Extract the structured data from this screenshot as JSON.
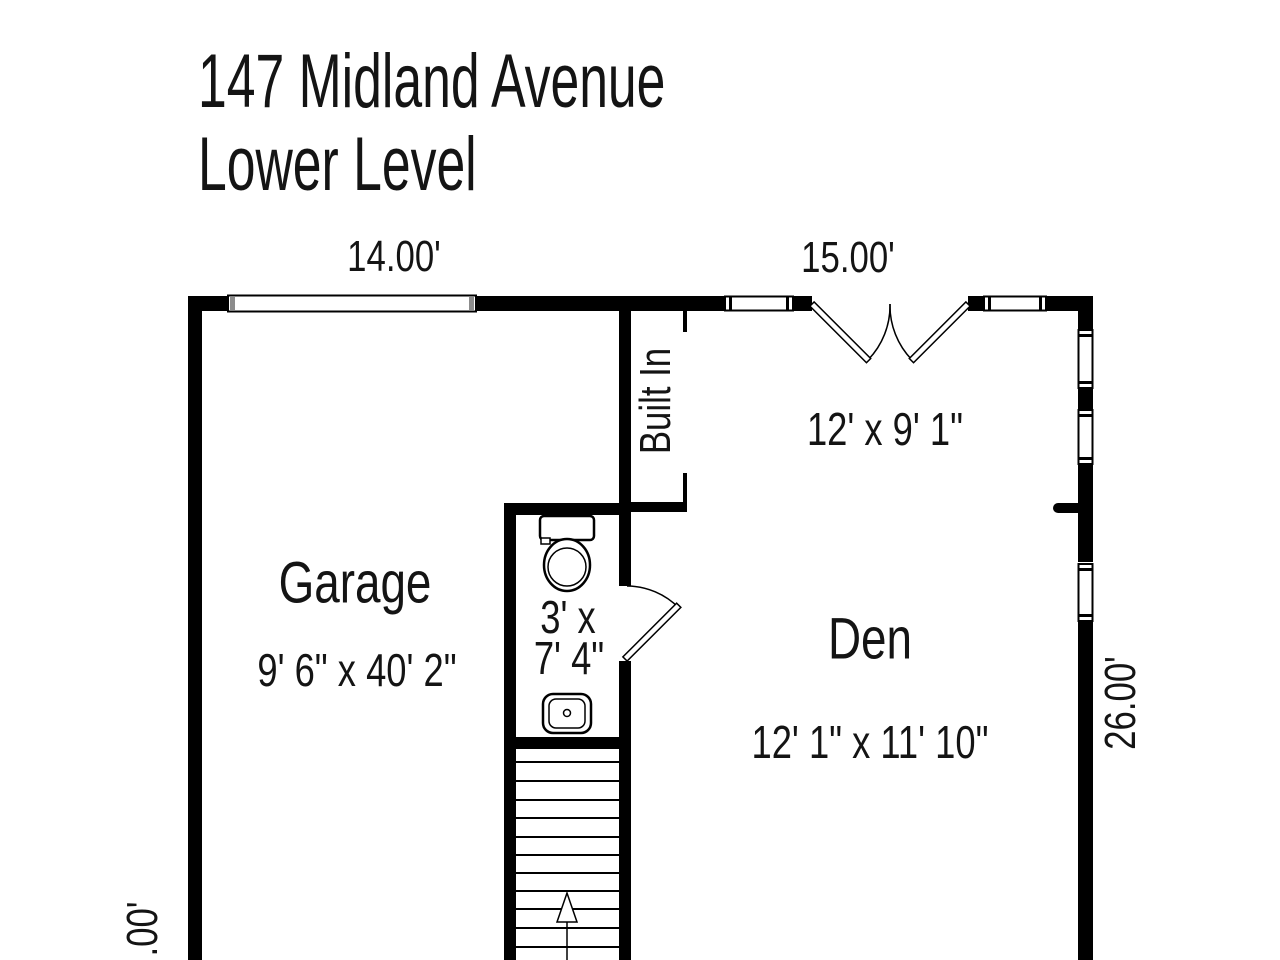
{
  "title": {
    "line1": "147 Midland Avenue",
    "line2": "Lower Level"
  },
  "dimension_labels": {
    "top_garage": "14.00'",
    "top_den": "15.00'",
    "right_den": "26.00'",
    "left_garage_partial": ".00'"
  },
  "rooms": {
    "garage": {
      "name": "Garage",
      "dimensions": "9' 6\" x 40' 2\""
    },
    "den": {
      "name": "Den",
      "dimensions": "12' 1\" x 11' 10\""
    },
    "den_upper": {
      "dimensions": "12' x 9' 1\""
    },
    "bathroom": {
      "dimensions_line1": "3' x",
      "dimensions_line2": "7' 4\""
    },
    "built_in": {
      "name": "Built In"
    }
  },
  "icons": {
    "toilet": "toilet-icon",
    "sink": "sink-icon",
    "stairs": "stairs-up-arrow-icon"
  },
  "colors": {
    "wall": "#000000",
    "background": "#ffffff",
    "garage_door_cap": "#8c8c8c",
    "text": "#141414"
  }
}
